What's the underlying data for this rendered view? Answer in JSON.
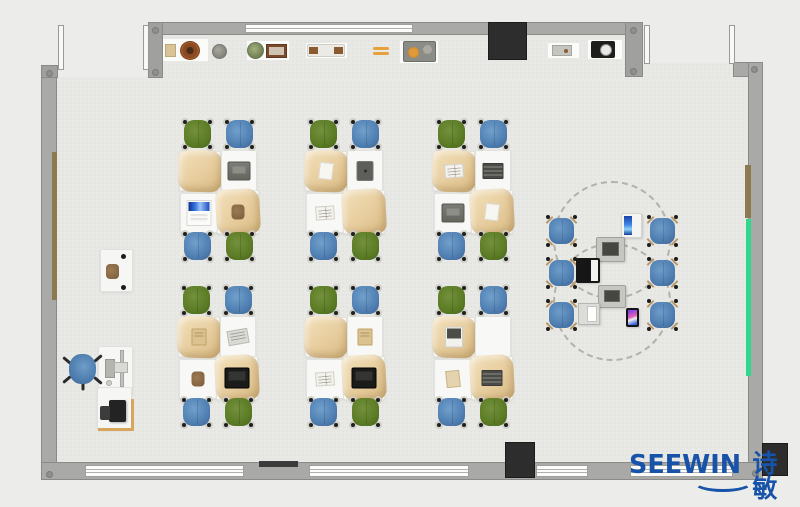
{
  "logo": {
    "brand": "SEEWIN",
    "brand_cn": "诗敏",
    "color": "#1753a8"
  },
  "palette": {
    "background": "#ececeb",
    "floor": "#e8e8e5",
    "wall": "#a9a9a7",
    "wall_edge": "#8a8a88",
    "window": "#fcfcfb",
    "chair_green": "#5c7c26",
    "chair_blue": "#5181b3",
    "stool_blue": "#4f7fb1",
    "bag_tan": "#e7cd9e",
    "wood_strip": "#8b7a50",
    "accent_green_strip": "#2fd98b",
    "display_black": "#2d2d2d",
    "logo_blue": "#1753a8"
  },
  "furniture": {
    "desk_groups": [
      {
        "id": 1,
        "x": 179,
        "y": 118,
        "chairs": [
          "green",
          "blue",
          "blue",
          "green"
        ],
        "desk_items": [
          "none",
          "laptop-gray",
          "laptop-blue",
          "pouch-brown"
        ]
      },
      {
        "id": 2,
        "x": 305,
        "y": 118,
        "chairs": [
          "green",
          "blue",
          "blue",
          "green"
        ],
        "desk_items": [
          "paper",
          "tablet-dark",
          "book-open",
          "none"
        ]
      },
      {
        "id": 3,
        "x": 433,
        "y": 118,
        "chairs": [
          "green",
          "blue",
          "blue",
          "green"
        ],
        "desk_items": [
          "book-open",
          "notebook-dark",
          "laptop-gray",
          "paper"
        ]
      },
      {
        "id": 4,
        "x": 178,
        "y": 284,
        "chairs": [
          "green",
          "blue",
          "blue",
          "green"
        ],
        "desk_items": [
          "book-tan",
          "newspaper",
          "pouch-brown",
          "laptop-black"
        ]
      },
      {
        "id": 5,
        "x": 305,
        "y": 284,
        "chairs": [
          "green",
          "blue",
          "blue",
          "green"
        ],
        "desk_items": [
          "none",
          "book-tan",
          "book-open",
          "laptop-black"
        ]
      },
      {
        "id": 6,
        "x": 433,
        "y": 284,
        "chairs": [
          "green",
          "blue",
          "blue",
          "green"
        ],
        "desk_items": [
          "laptop-white-dark",
          "none",
          "paper-tan",
          "notebook-dark"
        ]
      }
    ],
    "discussion_area": {
      "circles": [
        {
          "cx": 612,
          "cy": 240,
          "r": 59
        },
        {
          "cx": 612,
          "cy": 302,
          "r": 59
        }
      ],
      "stools": [
        {
          "x": 546,
          "y": 215
        },
        {
          "x": 647,
          "y": 215
        },
        {
          "x": 546,
          "y": 257
        },
        {
          "x": 647,
          "y": 257
        },
        {
          "x": 546,
          "y": 299
        },
        {
          "x": 647,
          "y": 299
        }
      ],
      "devices": [
        {
          "type": "tablet-blue",
          "x": 621,
          "y": 213,
          "w": 21,
          "h": 25
        },
        {
          "type": "copier",
          "x": 596,
          "y": 237,
          "w": 29,
          "h": 25
        },
        {
          "type": "laptop-black-open",
          "x": 576,
          "y": 258,
          "w": 24,
          "h": 25
        },
        {
          "type": "copier",
          "x": 598,
          "y": 285,
          "w": 28,
          "h": 23
        },
        {
          "type": "laptop-white-open",
          "x": 578,
          "y": 303,
          "w": 22,
          "h": 22
        },
        {
          "type": "tablet-color",
          "x": 626,
          "y": 308,
          "w": 13,
          "h": 19
        }
      ]
    },
    "teacher_zone": {
      "items": [
        {
          "type": "desk-white",
          "name": "single-student-desk",
          "x": 100,
          "y": 249,
          "w": 33,
          "h": 43
        },
        {
          "type": "pouch",
          "name": "bag-on-desk",
          "x": 106,
          "y": 264,
          "w": 13,
          "h": 15
        },
        {
          "type": "legdot",
          "name": "desk-leg",
          "x": 121,
          "y": 254,
          "w": 5,
          "h": 5
        },
        {
          "type": "legdot",
          "name": "desk-leg",
          "x": 121,
          "y": 285,
          "w": 5,
          "h": 5
        },
        {
          "type": "office-chair",
          "name": "teacher-chair",
          "x": 66,
          "y": 351,
          "w": 33,
          "h": 38
        },
        {
          "type": "desk-white",
          "name": "teacher-desk",
          "x": 98,
          "y": 346,
          "w": 35,
          "h": 47
        },
        {
          "type": "keyboard",
          "name": "keyboard",
          "x": 105,
          "y": 359,
          "w": 10,
          "h": 19
        },
        {
          "type": "mouse",
          "name": "mouse",
          "x": 106,
          "y": 380,
          "w": 6,
          "h": 6
        },
        {
          "type": "monitor-bar",
          "name": "monitor",
          "x": 120,
          "y": 350,
          "w": 4,
          "h": 37
        },
        {
          "type": "monitor-base",
          "name": "monitor-stand",
          "x": 114,
          "y": 362,
          "w": 14,
          "h": 11
        },
        {
          "type": "desk-white",
          "name": "teacher-return-desk",
          "x": 97,
          "y": 387,
          "w": 35,
          "h": 43
        },
        {
          "type": "printer",
          "name": "printer",
          "x": 109,
          "y": 400,
          "w": 17,
          "h": 22
        },
        {
          "type": "printer-side",
          "name": "printer-tray",
          "x": 100,
          "y": 406,
          "w": 10,
          "h": 14
        },
        {
          "type": "trim-v",
          "name": "desk-trim",
          "x": 131,
          "y": 399,
          "w": 3,
          "h": 31
        },
        {
          "type": "trim-h",
          "name": "desk-trim",
          "x": 98,
          "y": 428,
          "w": 36,
          "h": 3
        }
      ]
    },
    "shelf": {
      "cabinets": [
        {
          "x": 161,
          "y": 38,
          "w": 48,
          "h": 24
        },
        {
          "x": 246,
          "y": 40,
          "w": 44,
          "h": 21
        },
        {
          "x": 305,
          "y": 42,
          "w": 43,
          "h": 17
        },
        {
          "x": 399,
          "y": 40,
          "w": 40,
          "h": 24
        },
        {
          "x": 547,
          "y": 42,
          "w": 33,
          "h": 17
        },
        {
          "x": 587,
          "y": 39,
          "w": 36,
          "h": 21
        }
      ],
      "items": [
        {
          "type": "box-tan",
          "x": 165,
          "y": 44,
          "w": 11,
          "h": 13
        },
        {
          "type": "bowl-brown",
          "x": 180,
          "y": 41,
          "w": 20,
          "h": 19
        },
        {
          "type": "pot-gray",
          "x": 212,
          "y": 44,
          "w": 15,
          "h": 15
        },
        {
          "type": "plant-green",
          "x": 247,
          "y": 42,
          "w": 17,
          "h": 17
        },
        {
          "type": "frame-brown",
          "x": 266,
          "y": 44,
          "w": 21,
          "h": 14
        },
        {
          "type": "bench-brown",
          "x": 307,
          "y": 44,
          "w": 38,
          "h": 13
        },
        {
          "type": "bars-orange",
          "x": 373,
          "y": 47,
          "w": 16,
          "h": 8
        },
        {
          "type": "machine-gray",
          "x": 403,
          "y": 41,
          "w": 33,
          "h": 21
        },
        {
          "type": "tablet-gray",
          "x": 552,
          "y": 45,
          "w": 20,
          "h": 11
        },
        {
          "type": "device-black",
          "x": 591,
          "y": 41,
          "w": 24,
          "h": 17
        }
      ]
    }
  }
}
